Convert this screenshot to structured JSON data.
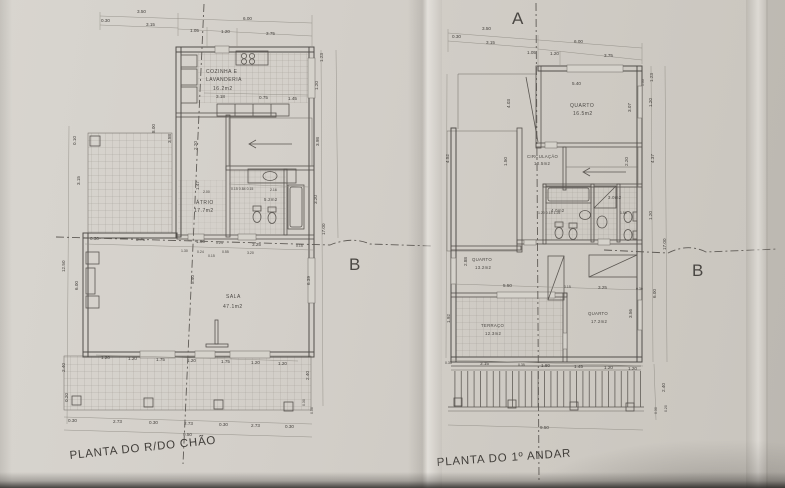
{
  "paper": {
    "background": "#d2cec7",
    "line_color": "#514e4a",
    "dim_color": "#908c85",
    "text_color": "#45423e"
  },
  "ground_plan": {
    "title": "PLANTA DO R/DO CHÃO",
    "rooms": {
      "kitchen": {
        "line1": "COZINHA E",
        "line2": "LAVANDERIA",
        "area": "16.2m2"
      },
      "atrio": {
        "name": "ÁTRIO",
        "area": "17.7m2"
      },
      "bath": {
        "area": "5.2m2"
      },
      "sala": {
        "name": "SALA",
        "area": "47.1m2"
      }
    },
    "dims_top": [
      "3.50",
      "0.30",
      "3.15",
      "6.00",
      "1.05",
      "1.20",
      "3.75"
    ],
    "dims_left": [
      "0.10",
      "3.15",
      "12.50",
      "6.00",
      "2.40",
      "0.20"
    ],
    "dims_inner": [
      "8.00",
      "3.58",
      "2.20",
      "1.47",
      "5.40"
    ],
    "dims_right": [
      "1.23",
      "1.20",
      "3.98",
      "3.20",
      "17.00",
      "6.39",
      "2.40",
      "0.30",
      "0.50"
    ],
    "dims_sala_top": [
      "0.30",
      "3.75",
      "1.90",
      "0.24",
      "3.25",
      "0.15"
    ],
    "dims_atrio": [
      "1.30",
      "0.24",
      "0.15",
      "3.20",
      "0.55"
    ],
    "dims_sala_bottom": [
      "1.20",
      "1.20",
      "1.75",
      "1.20",
      "1.75",
      "1.20",
      "1.20"
    ],
    "dims_porch": [
      "0.30",
      "2.73",
      "0.30",
      "2.73",
      "0.30",
      "2.73",
      "0.30"
    ],
    "dim_total": "9.50",
    "dims_kitchen": [
      "3.18",
      "0.75",
      "1.45"
    ],
    "dims_bath": [
      "2.00",
      "0.15 0.84 0.15",
      "2.16"
    ]
  },
  "first_plan": {
    "title": "PLANTA DO 1º ANDAR",
    "rooms": {
      "bedroom1": {
        "name": "QUARTO",
        "area": "16.5m2"
      },
      "circulation": {
        "name": "CIRCULAÇÃO",
        "area": "10.5m2"
      },
      "bath": {
        "area": "4.0m2"
      },
      "wc": {
        "area": "3.0m2"
      },
      "bedroom2": {
        "name": "QUARTO",
        "area": "13.2m2"
      },
      "terrace": {
        "name": "TERRAÇO",
        "area": "12.3m2"
      },
      "bedroom3": {
        "name": "QUARTO",
        "area": "17.2m2"
      }
    },
    "dims_top": [
      "3.50",
      "0.30",
      "3.15",
      "6.00",
      "1.05",
      "1.20",
      "3.75"
    ],
    "dims_right": [
      "1.23",
      "1.20",
      "4.37",
      "1.20",
      "17.00",
      "6.00",
      "3.56"
    ],
    "dims_inner": [
      "5.40",
      "3.07",
      "1.33",
      "2.20",
      "4.03",
      "1.50"
    ],
    "dims_left": [
      "4.52",
      "2.88",
      "1.92"
    ],
    "dims_mid": [
      "5.50",
      "0.15",
      "3.25",
      "0.30"
    ],
    "dims_bottom": [
      "0.35",
      "3.15",
      "0.35",
      "1.80",
      "1.45",
      "1.20",
      "1.20"
    ],
    "dim_total": "9.50",
    "dims_bottom_right": [
      "2.40",
      "0.30",
      "0.20"
    ],
    "dims_bath": [
      "1.20 0.15 1.25",
      "1.50"
    ]
  },
  "markers": {
    "section_a": "A",
    "section_b": "B"
  }
}
